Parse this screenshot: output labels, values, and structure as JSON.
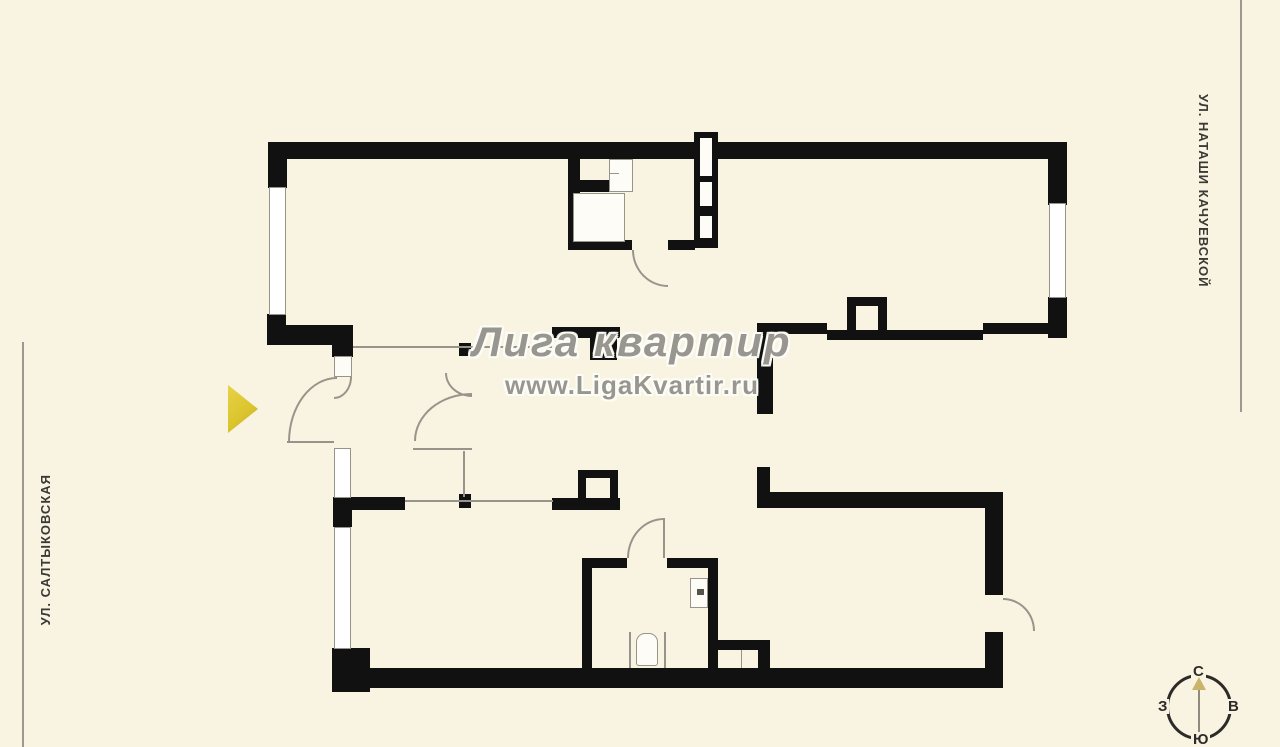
{
  "canvas": {
    "width": 1280,
    "height": 747,
    "background_color": "#f9f4e2",
    "wall_color": "#111111",
    "thin_line_color": "#97958b",
    "window_fill_color": "#ffffff",
    "entrance_marker_color": "#dcc52e"
  },
  "watermark": {
    "title": "Лига квартир",
    "url": "www.LigaKvartir.ru",
    "color": "#8a887f"
  },
  "streets": {
    "left": "УЛ. САЛТЫКОВСКАЯ",
    "right": "УЛ. НАТАШИ КАЧУЕВСКОЙ"
  },
  "compass": {
    "north": "С",
    "south": "Ю",
    "west": "З",
    "east": "В",
    "needle_color": "#c9b469"
  },
  "plan": {
    "walls": [
      [
        268,
        142,
        799,
        17
      ],
      [
        268,
        142,
        19,
        46
      ],
      [
        267,
        314,
        19,
        31
      ],
      [
        267,
        325,
        86,
        20
      ],
      [
        332,
        345,
        21,
        12
      ],
      [
        1048,
        142,
        19,
        63
      ],
      [
        1048,
        297,
        19,
        41
      ],
      [
        568,
        158,
        12,
        92
      ],
      [
        568,
        180,
        42,
        12
      ],
      [
        568,
        240,
        64,
        10
      ],
      [
        668,
        240,
        27,
        10
      ],
      [
        694,
        132,
        24,
        116
      ],
      [
        552,
        327,
        68,
        11
      ],
      [
        590,
        338,
        27,
        22
      ],
      [
        757,
        323,
        70,
        11
      ],
      [
        827,
        330,
        156,
        10
      ],
      [
        983,
        323,
        84,
        11
      ],
      [
        847,
        297,
        40,
        9
      ],
      [
        847,
        297,
        9,
        37
      ],
      [
        878,
        297,
        9,
        37
      ],
      [
        757,
        334,
        16,
        80
      ],
      [
        757,
        467,
        13,
        36
      ],
      [
        757,
        492,
        246,
        16
      ],
      [
        459,
        343,
        12,
        13
      ],
      [
        333,
        497,
        72,
        13
      ],
      [
        333,
        497,
        19,
        30
      ],
      [
        459,
        494,
        12,
        14
      ],
      [
        552,
        498,
        68,
        12
      ],
      [
        578,
        470,
        40,
        8
      ],
      [
        578,
        470,
        8,
        40
      ],
      [
        610,
        470,
        8,
        40
      ],
      [
        332,
        648,
        38,
        44
      ],
      [
        332,
        668,
        671,
        20
      ],
      [
        582,
        558,
        10,
        114
      ],
      [
        582,
        558,
        45,
        10
      ],
      [
        667,
        558,
        51,
        10
      ],
      [
        708,
        558,
        10,
        114
      ],
      [
        718,
        640,
        52,
        10
      ],
      [
        758,
        640,
        12,
        32
      ],
      [
        985,
        495,
        18,
        100
      ],
      [
        985,
        632,
        18,
        56
      ]
    ],
    "windows": [
      [
        269,
        187,
        17,
        128
      ],
      [
        1049,
        203,
        17,
        95
      ],
      [
        334,
        448,
        17,
        50
      ],
      [
        334,
        527,
        17,
        122
      ]
    ],
    "white_boxes": [
      [
        609,
        159,
        24,
        33
      ],
      [
        573,
        193,
        52,
        49
      ],
      [
        334,
        356,
        18,
        21
      ],
      [
        690,
        578,
        18,
        30
      ],
      [
        636,
        633,
        22,
        33,
        "9px 9px 3px 3px"
      ]
    ],
    "shaft_inner": [
      [
        700,
        138,
        12,
        38
      ],
      [
        700,
        182,
        12,
        24
      ],
      [
        700,
        216,
        12,
        22
      ]
    ],
    "thin_lines": [
      [
        353,
        346,
        199,
        2
      ],
      [
        405,
        500,
        148,
        2
      ],
      [
        463,
        451,
        2,
        46
      ],
      [
        287,
        441,
        47,
        2
      ],
      [
        413,
        448,
        59,
        2
      ],
      [
        741,
        650,
        1,
        18
      ],
      [
        629,
        632,
        2,
        36
      ],
      [
        664,
        632,
        2,
        36
      ],
      [
        663,
        518,
        2,
        40
      ],
      [
        609,
        173,
        10,
        1
      ]
    ],
    "marks": [
      [
        697,
        589,
        7,
        6
      ]
    ],
    "door_arcs": [
      {
        "x": 632,
        "y": 250,
        "w": 36,
        "h": 37,
        "corner": "bl"
      },
      {
        "x": 288,
        "y": 377,
        "w": 49,
        "h": 65,
        "corner": "tl"
      },
      {
        "x": 334,
        "y": 377,
        "w": 18,
        "h": 22,
        "corner": "br"
      },
      {
        "x": 445,
        "y": 373,
        "w": 27,
        "h": 24,
        "corner": "bl"
      },
      {
        "x": 414,
        "y": 393,
        "w": 58,
        "h": 48,
        "corner": "tl"
      },
      {
        "x": 627,
        "y": 518,
        "w": 37,
        "h": 40,
        "corner": "tl"
      },
      {
        "x": 1003,
        "y": 598,
        "w": 32,
        "h": 33,
        "corner": "tr"
      }
    ],
    "guide_lines": [
      [
        22,
        342,
        2,
        405
      ],
      [
        1240,
        0,
        2,
        412
      ]
    ]
  }
}
